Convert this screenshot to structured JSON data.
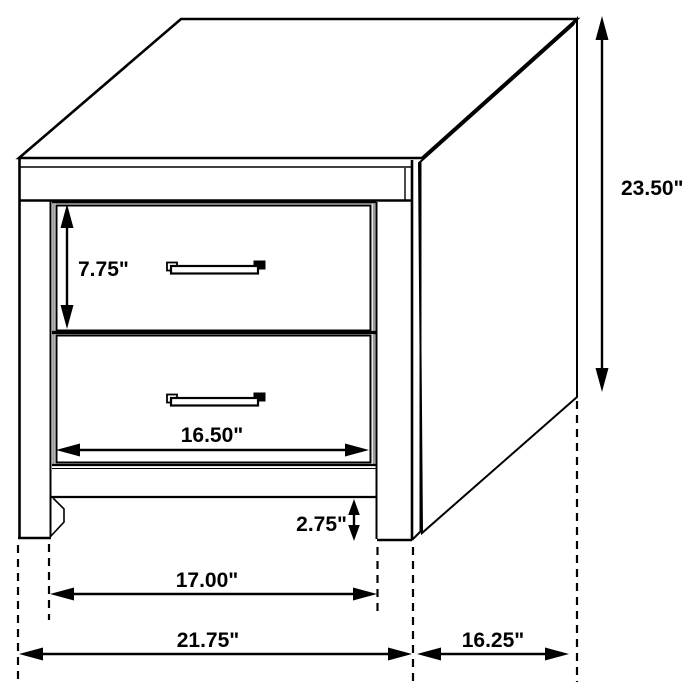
{
  "diagram": {
    "type": "furniture-dimension-drawing",
    "subject": "two-drawer nightstand",
    "background_color": "#ffffff",
    "line_color": "#000000",
    "labels": {
      "overall_height": "23.50\"",
      "drawer_opening_height": "7.75\"",
      "drawer_width": "16.50\"",
      "leg_height": "2.75\"",
      "between_legs_width": "17.00\"",
      "overall_width": "21.75\"",
      "depth": "16.25\""
    }
  }
}
